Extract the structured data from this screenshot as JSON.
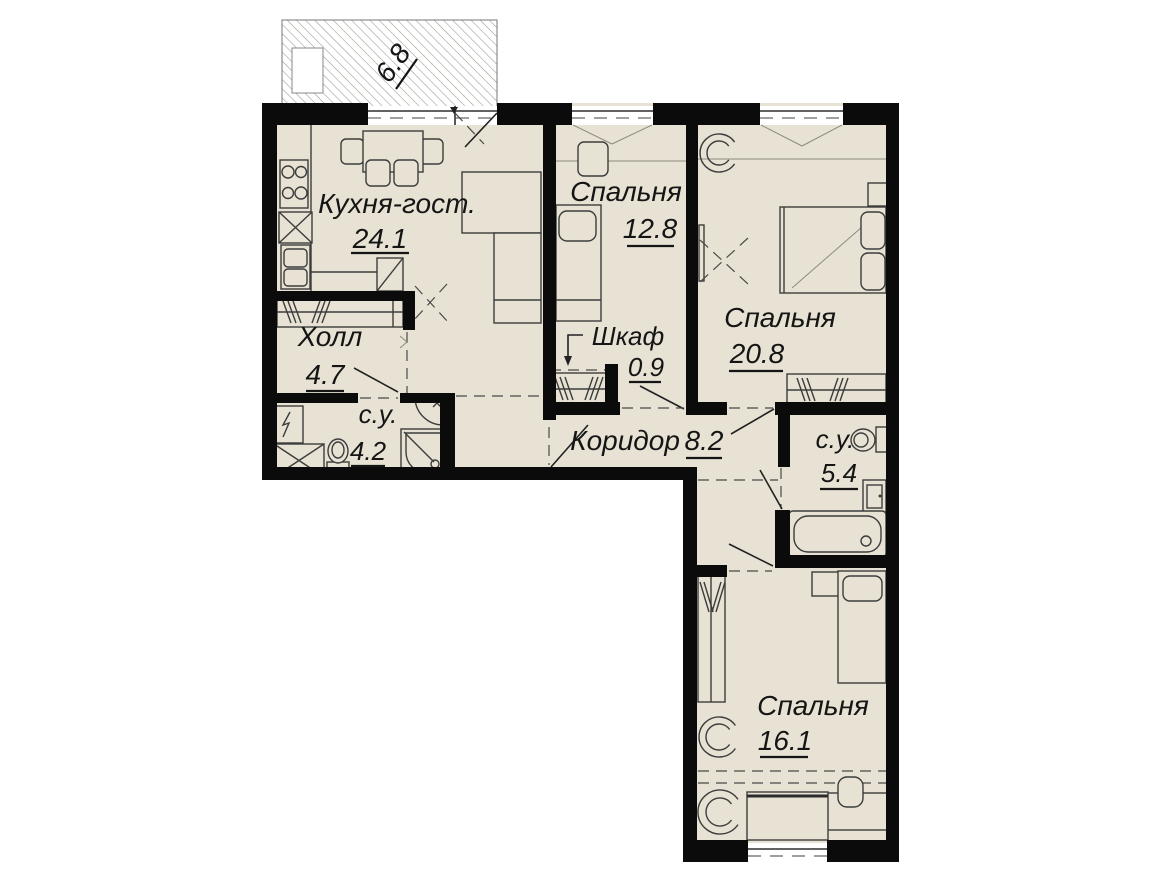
{
  "plan": {
    "type": "apartment-floor-plan",
    "balcony": {
      "area": "6.8"
    },
    "rooms": {
      "kitchen": {
        "name": "Кухня-гост.",
        "area": "24.1"
      },
      "bedroom1": {
        "name": "Спальня",
        "area": "12.8"
      },
      "bedroom2": {
        "name": "Спальня",
        "area": "20.8"
      },
      "hall": {
        "name": "Холл",
        "area": "4.7"
      },
      "bath1": {
        "name": "с.у.",
        "area": "4.2"
      },
      "closet": {
        "name": "Шкаф",
        "area": "0.9"
      },
      "corridor": {
        "name": "Коридор",
        "area": "8.2"
      },
      "bath2": {
        "name": "с.у.",
        "area": "5.4"
      },
      "bedroom3": {
        "name": "Спальня",
        "area": "16.1"
      }
    },
    "colors": {
      "floor": "#e7e2d3",
      "wall": "#0b0b0b",
      "line": "#3c3c3c",
      "hatch": "#9a978c"
    }
  }
}
